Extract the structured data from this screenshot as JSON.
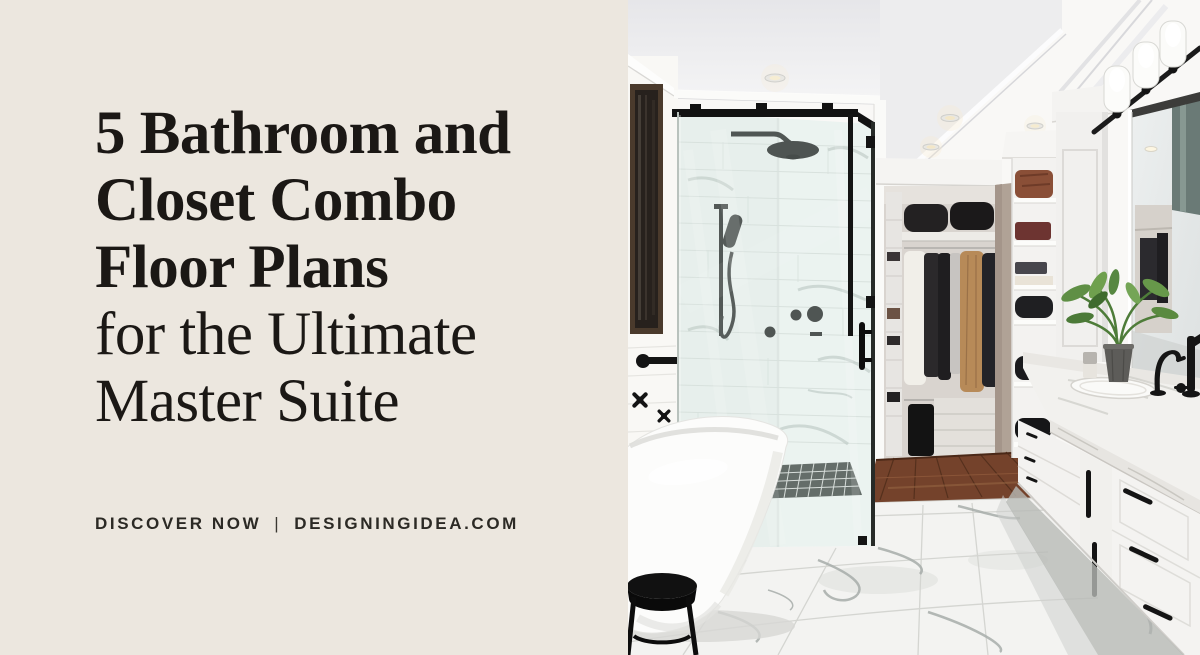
{
  "banner": {
    "title_full": "5 Bathroom and Closet Combo Floor Plans for the Ultimate Master Suite",
    "headline": {
      "lines": [
        "5 Bathroom and",
        "Closet Combo",
        "Floor Plans",
        "for the Ultimate",
        "Master Suite"
      ]
    },
    "footer": {
      "cta": "DISCOVER NOW",
      "separator": "|",
      "site": "DESIGNINGIDEA.COM"
    },
    "colors": {
      "panel_background": "#ECE7DF",
      "headline_text": "#1B1815",
      "footer_text": "#2C2A25",
      "fixture_black": "#141414",
      "wood_floor": "#74422B",
      "camel_coat": "#B78A58",
      "leather_bag": "#8A4F37",
      "plant_green": "#5B8C43",
      "marble_vein": "#A7ADAA"
    },
    "photo": {
      "description": "Master bathroom with black-framed glass shower, freestanding white tub, walk-in closet with hanging clothes and shelving, white double vanity with marble counter, black fixtures and marble tile floor"
    }
  }
}
